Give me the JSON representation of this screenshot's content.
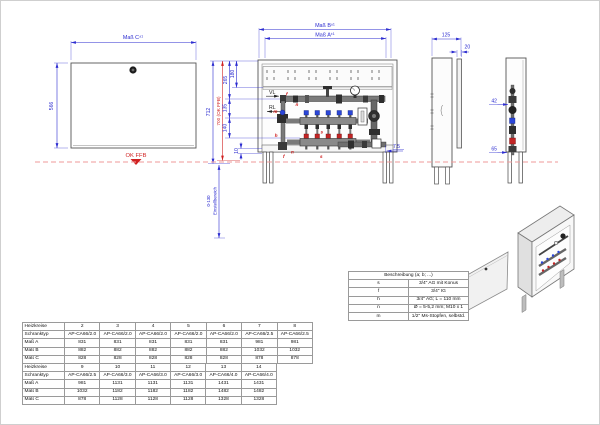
{
  "drawing": {
    "tolerance": "±1",
    "front_view": {
      "dim_width": "Maß C",
      "dim_height": "566",
      "floor_label": "OK FFB"
    },
    "manifold_view": {
      "dim_b": "Maß B",
      "dim_a": "Maß A",
      "dim_712": "712",
      "dim_700": "700 (OK FFB)",
      "dim_265": "265",
      "dim_180": "180",
      "dim_135": "135",
      "dim_140": "140",
      "dim_10": "10",
      "dim_75": "7.5",
      "adjust_range_value": "0-130",
      "adjust_range_label": "Einstellbereich",
      "vl_label": "VL",
      "rl_label": "RL",
      "letter_f": "f",
      "letter_n": "n",
      "letter_m": "m",
      "letter_h": "h",
      "letter_s": "s"
    },
    "side_views": {
      "dim_depth": "125",
      "dim_door_gap": "20",
      "dim_42": "42",
      "dim_65": "65"
    }
  },
  "legend": {
    "title": "Beschreibung (a; b; ...)",
    "rows": [
      [
        "s",
        "3/4\" AG mit Konus"
      ],
      [
        "f",
        "3/4\" IG"
      ],
      [
        "h",
        "3/4\" AG; L = 110 mm"
      ],
      [
        "n",
        "Ø = 5-5,2 mm; M10 x 1"
      ],
      [
        "m",
        "1/2\" Ms-Stopfen, selbstd."
      ]
    ]
  },
  "size_tables": {
    "table1": [
      [
        "Heizkreise",
        "2",
        "3",
        "4",
        "5",
        "6",
        "7",
        "8"
      ],
      [
        "Schranktyp",
        "AP-CA66/2.0",
        "AP-CA66/2.0",
        "AP-CA66/2.0",
        "AP-CA66/2.0",
        "AP-CA66/2.0",
        "AP-CA66/2.5",
        "AP-CA66/2.5"
      ],
      [
        "Maß A",
        "831",
        "831",
        "831",
        "831",
        "831",
        "981",
        "981"
      ],
      [
        "Maß B",
        "882",
        "882",
        "882",
        "882",
        "882",
        "1032",
        "1032"
      ],
      [
        "Maß C",
        "828",
        "828",
        "828",
        "828",
        "828",
        "878",
        "878"
      ]
    ],
    "table2": [
      [
        "Heizkreise",
        "9",
        "10",
        "11",
        "12",
        "13",
        "14"
      ],
      [
        "Schranktyp",
        "AP-CA66/2.5",
        "AP-CA66/3.0",
        "AP-CA66/3.0",
        "AP-CA66/3.0",
        "AP-CA66/4.0",
        "AP-CA66/4.0"
      ],
      [
        "Maß A",
        "981",
        "1131",
        "1131",
        "1131",
        "1431",
        "1431"
      ],
      [
        "Maß B",
        "1032",
        "1182",
        "1182",
        "1182",
        "1482",
        "1482"
      ],
      [
        "Maß C",
        "878",
        "1128",
        "1128",
        "1128",
        "1328",
        "1328"
      ]
    ]
  }
}
